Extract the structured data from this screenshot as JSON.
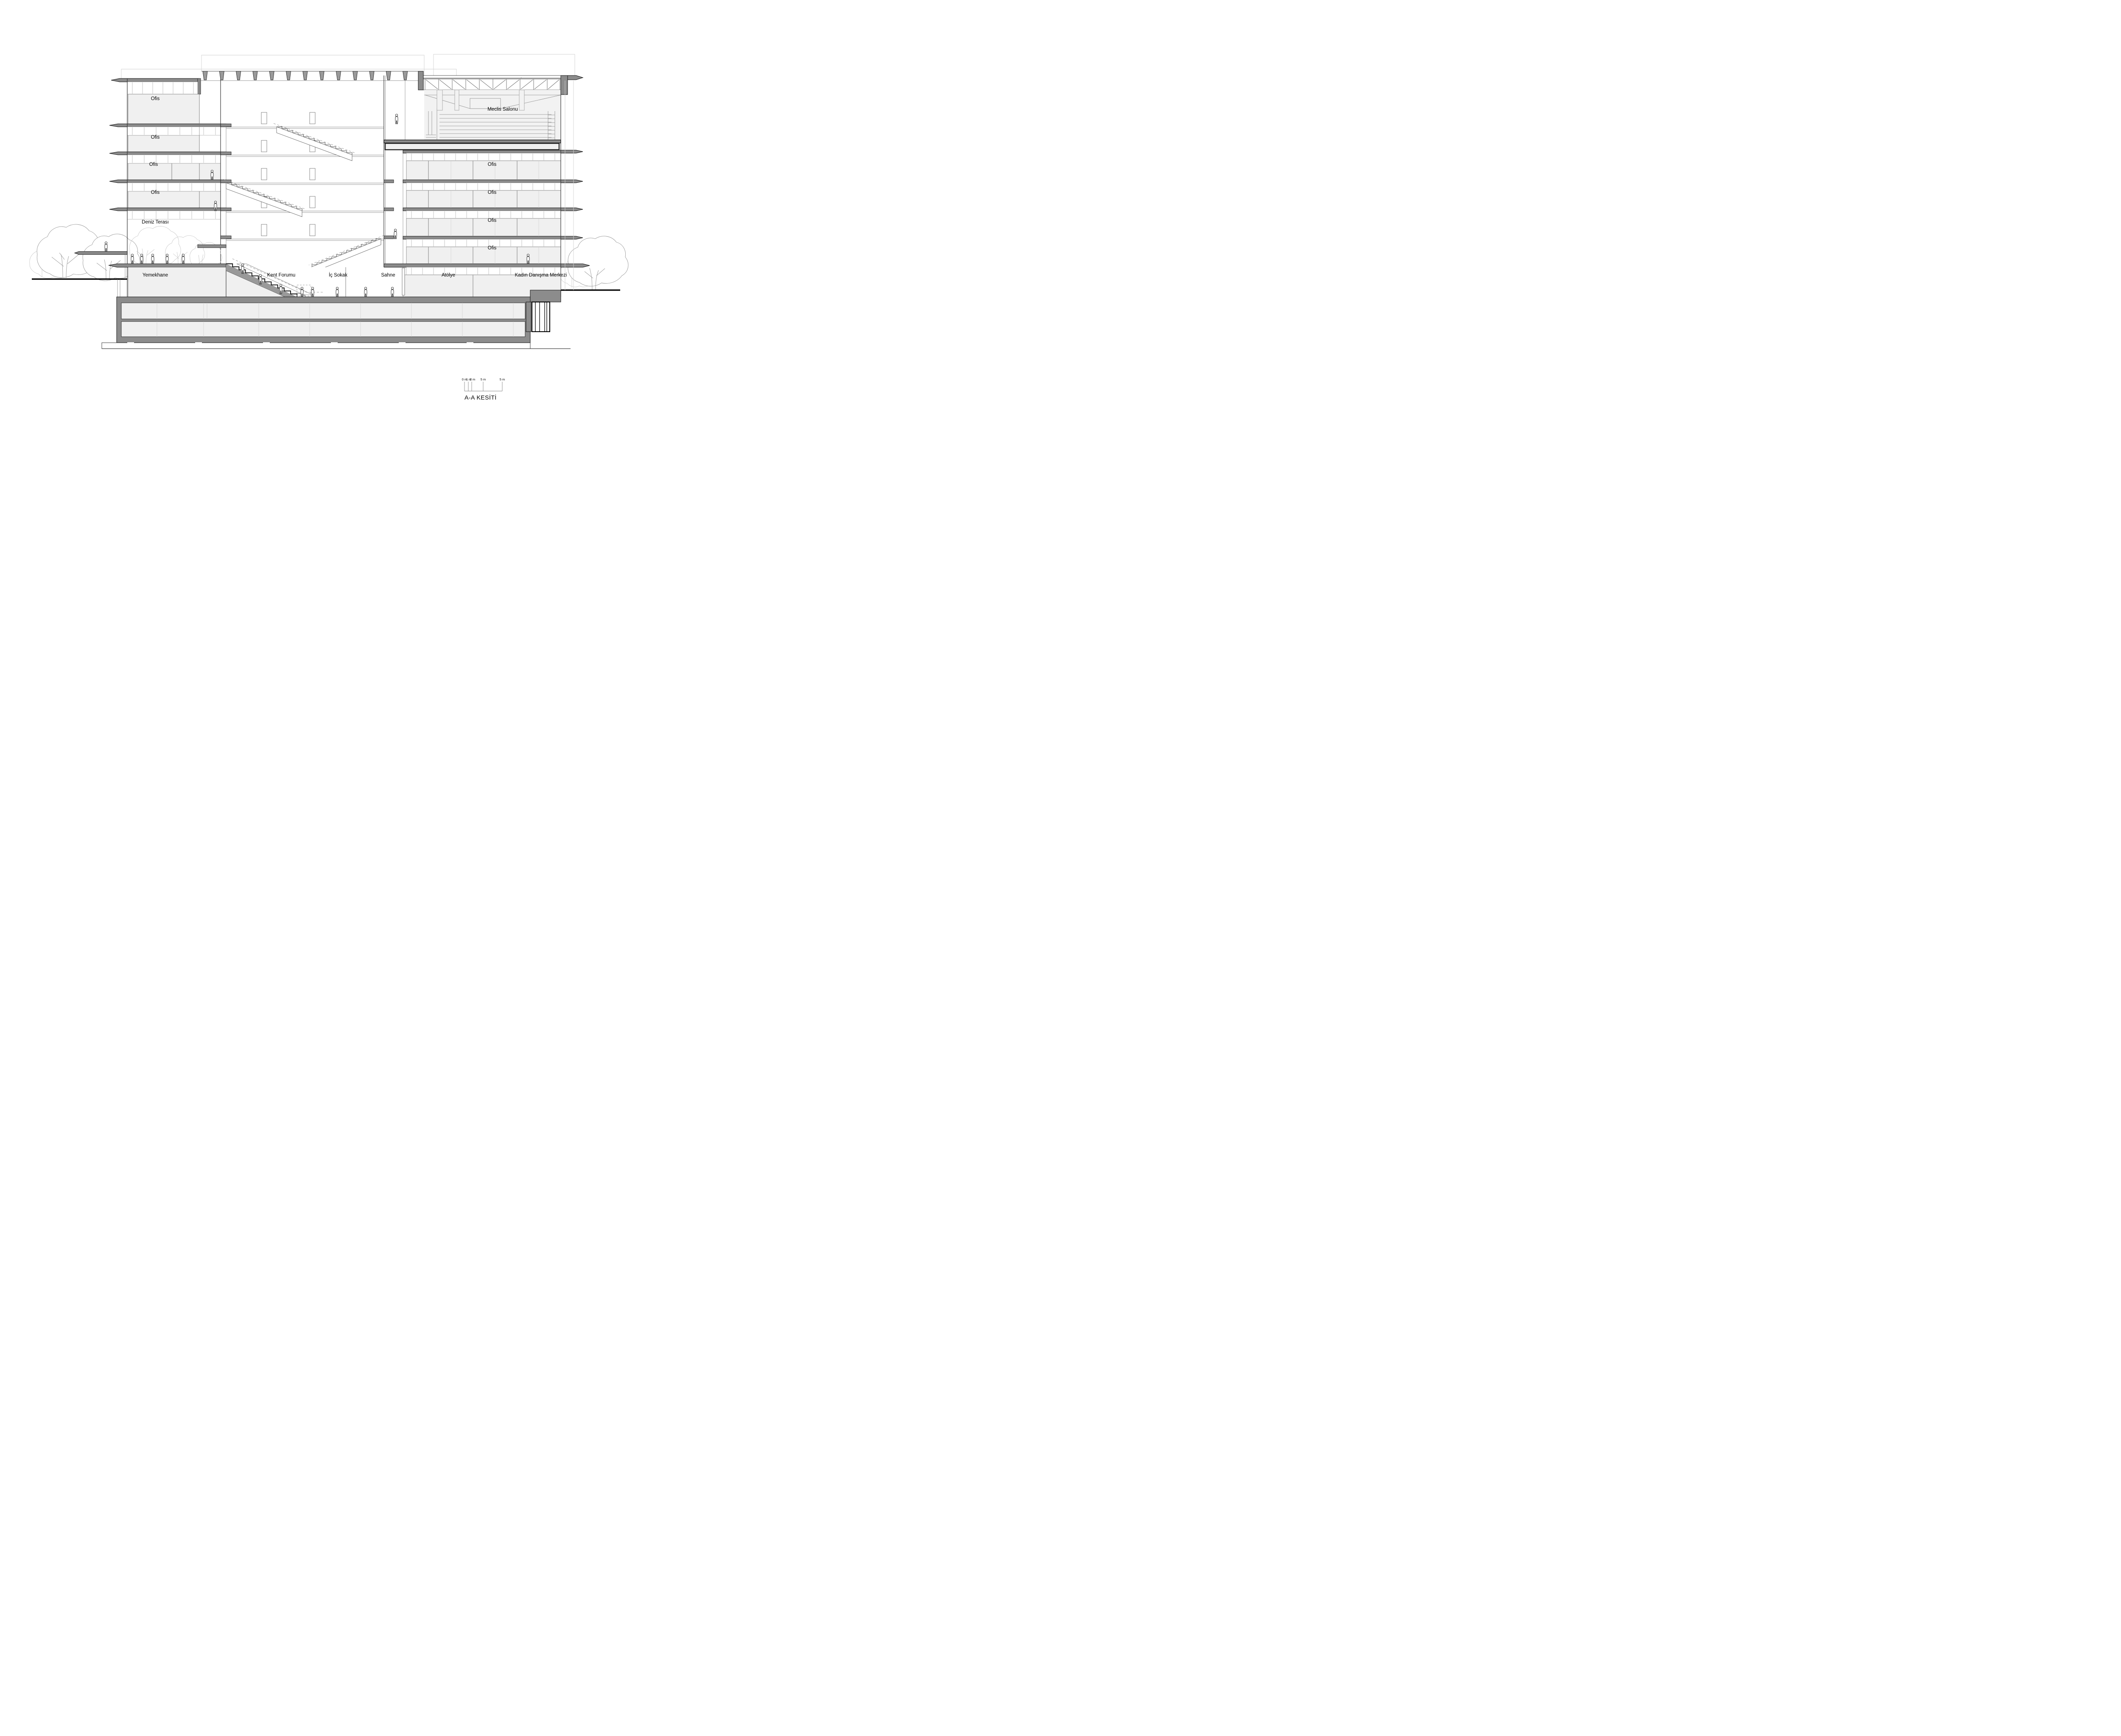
{
  "drawing": {
    "title": "A-A KESİTİ",
    "scale_bar": {
      "labels": [
        "0 m",
        "1 m",
        "2 m",
        "5 m",
        "5 m"
      ]
    },
    "labels": {
      "left_ofis": [
        "Ofis",
        "Ofis",
        "Ofis",
        "Ofis"
      ],
      "right_ofis": [
        "Ofis",
        "Ofis",
        "Ofis",
        "Ofis"
      ],
      "deniz_terasi": "Deniz Terası",
      "meclis_salonu": "Meclis Salonu",
      "yemekhane": "Yemekhane",
      "kent_forumu": "Kent Forumu",
      "ic_sokak": "İç Sokak",
      "sahne": "Sahne",
      "atolye": "Atölye",
      "kadin_danisma": "Kadın Danışma Merkezi"
    },
    "colors": {
      "slab_gray": "#8c8c8c",
      "room_fill": "#f0f0f0",
      "fin_gray": "#9a9a9a",
      "line_black": "#111111",
      "background": "#ffffff"
    }
  }
}
